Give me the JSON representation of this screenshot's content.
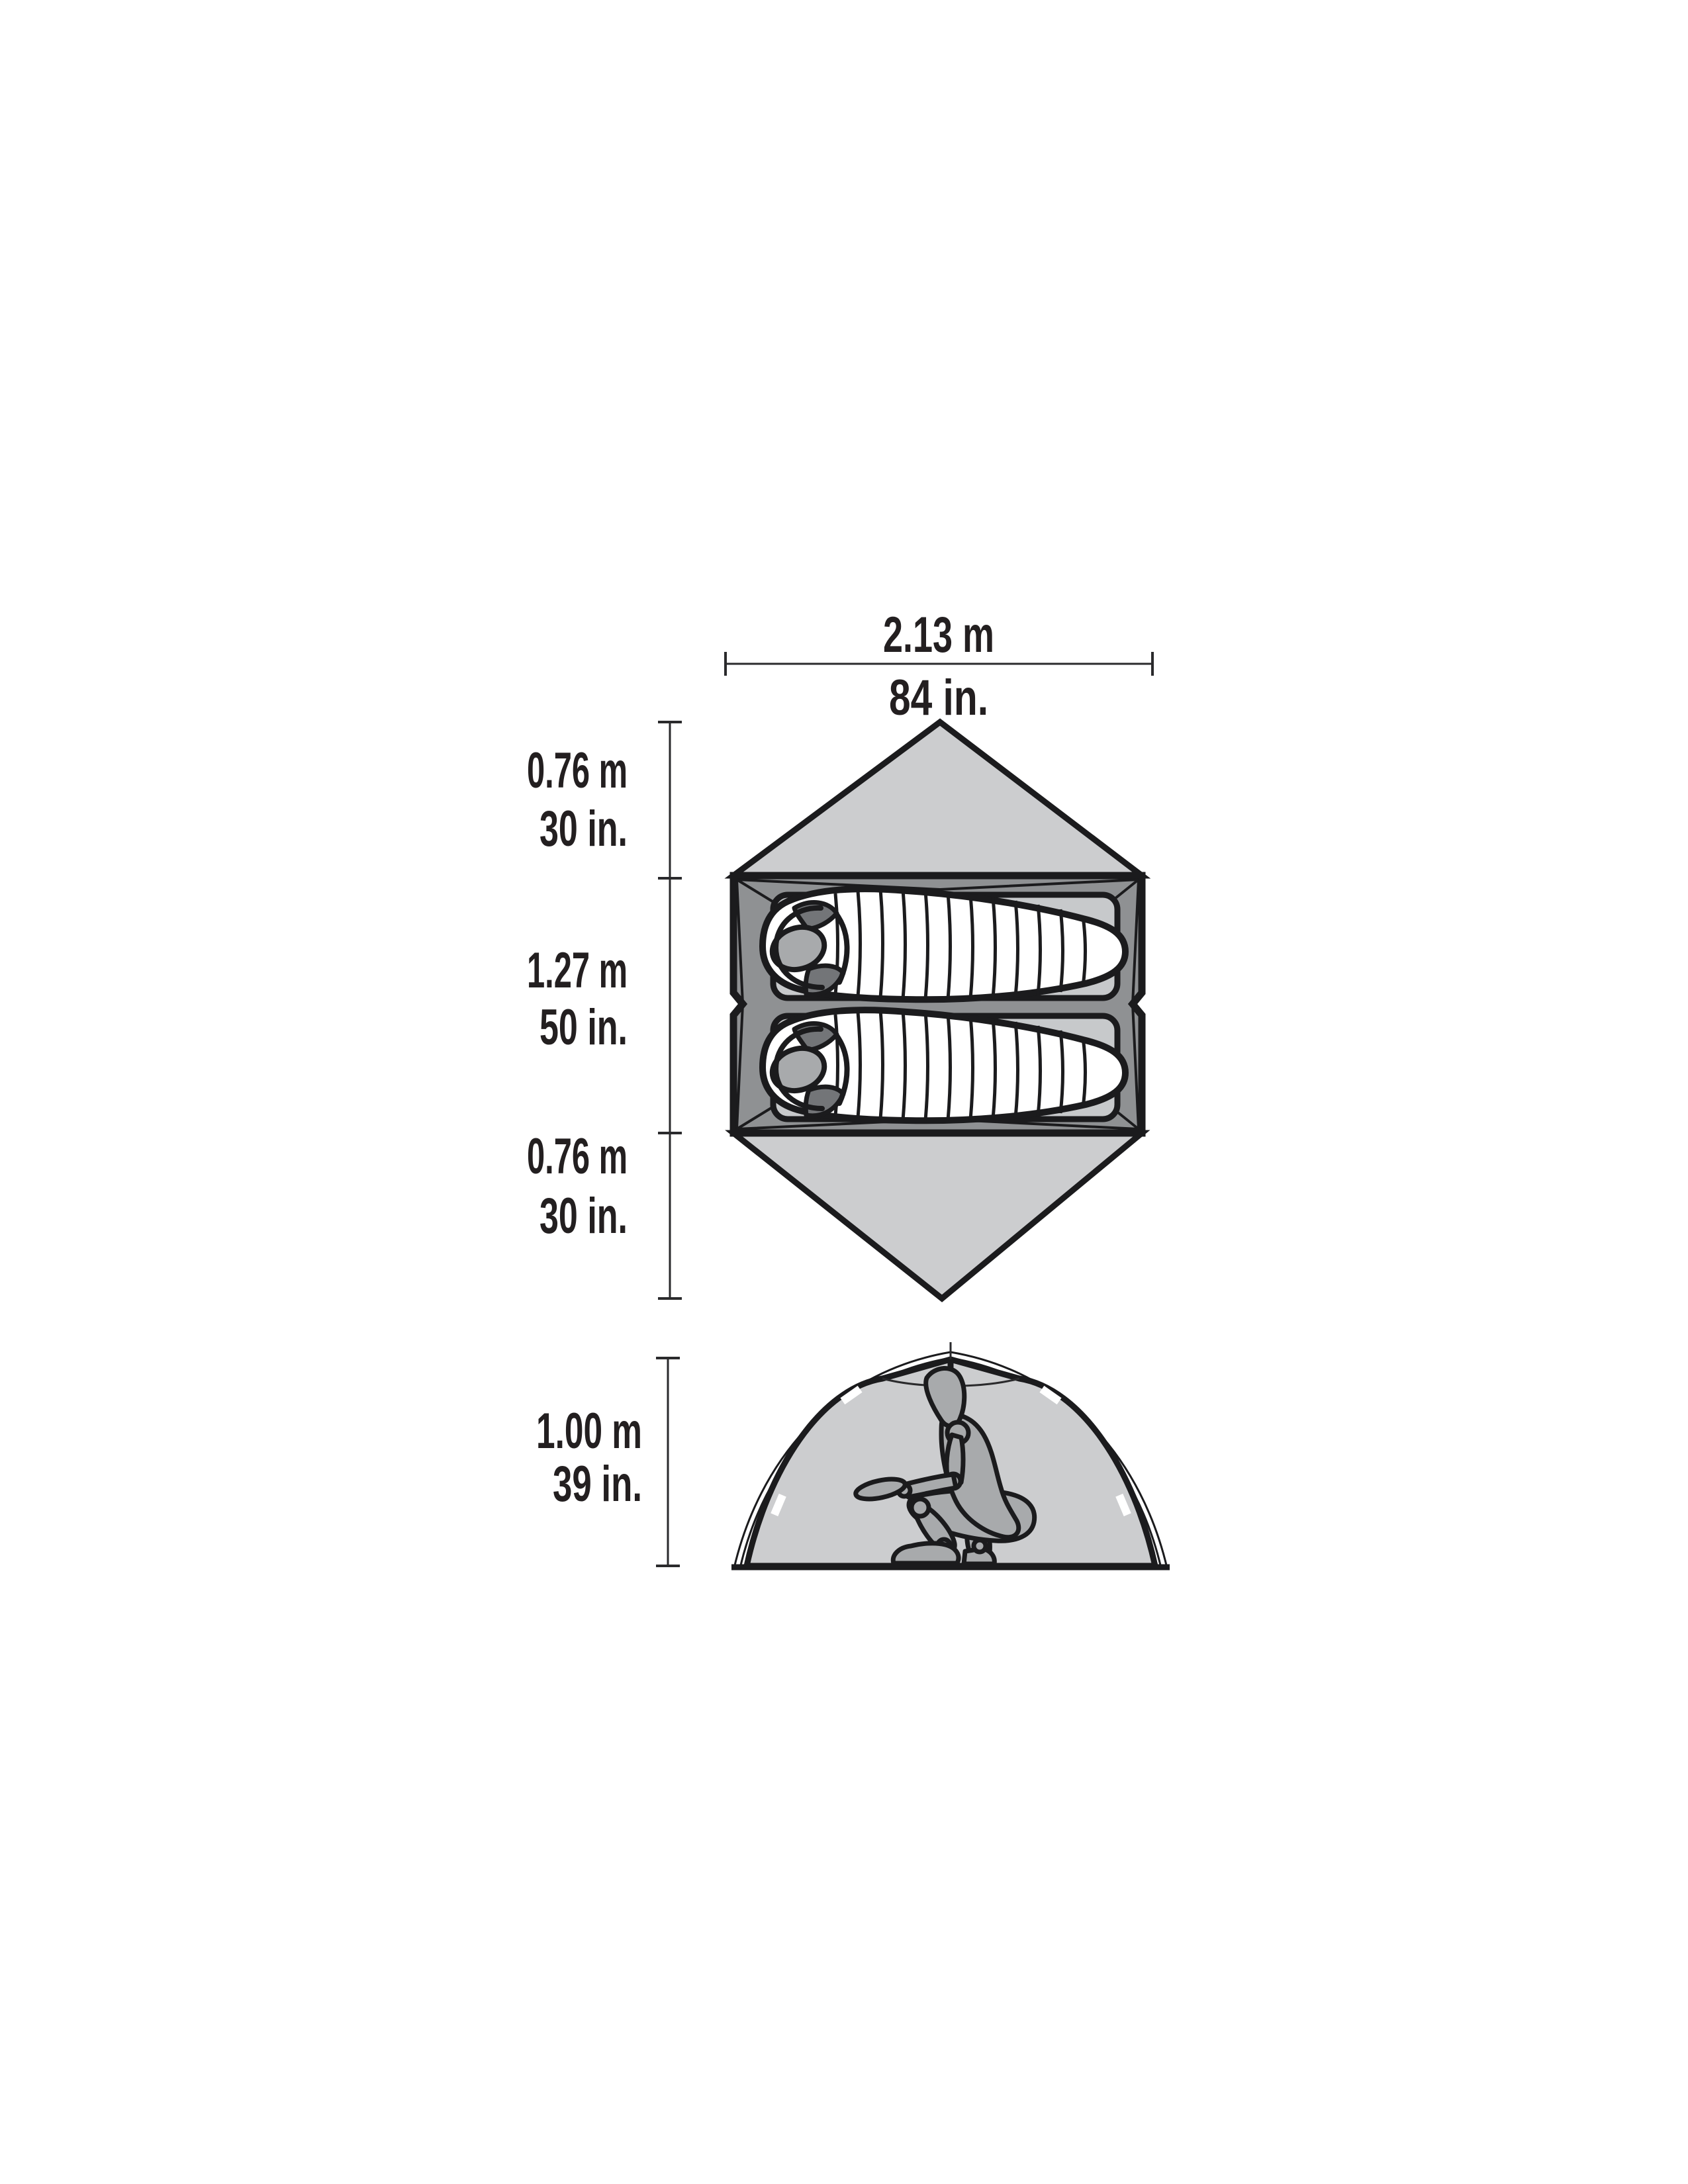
{
  "diagram": {
    "top_view": {
      "width": {
        "metric": "2.13 m",
        "imperial": "84 in."
      },
      "depth_sections": [
        {
          "metric": "0.76 m",
          "imperial": "30 in."
        },
        {
          "metric": "1.27 m",
          "imperial": "50 in."
        },
        {
          "metric": "0.76 m",
          "imperial": "30 in."
        }
      ]
    },
    "side_view": {
      "height": {
        "metric": "1.00 m",
        "imperial": "39 in."
      }
    },
    "colors": {
      "background": "#ffffff",
      "outline": "#1b1b1d",
      "fly_light_gray": "#cccdcf",
      "floor_gray": "#8f9193",
      "pad_gray": "#c7c9cb",
      "bag_white": "#ffffff",
      "figure_gray": "#a8aaac",
      "dark_accent_gray": "#737578",
      "dimension_line": "#2a2a2c",
      "text": "#231f20"
    }
  }
}
